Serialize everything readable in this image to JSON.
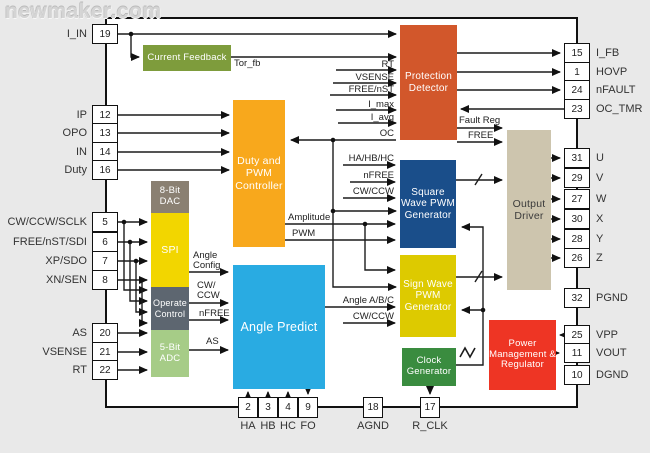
{
  "watermark": "newmaker.com",
  "colors": {
    "background": "#e9e9e9",
    "chip_fill": "#ffffff",
    "outline": "#111111",
    "current_feedback": "#7e9c3c",
    "duty_pwm": "#f8a81c",
    "dac": "#8a8072",
    "spi": "#f2d600",
    "operate_control": "#5d6670",
    "adc": "#a6cc87",
    "angle_predict": "#29abe2",
    "protection": "#d2572b",
    "square_pwm": "#1a4e8a",
    "sign_pwm": "#ddca00",
    "clock_gen": "#3a8c3f",
    "output_driver": "#cdc5ae",
    "power_mgmt": "#ee3524"
  },
  "blocks": {
    "current_feedback": "Current Feedback",
    "duty_pwm": "Duty and PWM Controller",
    "dac_8bit": "8-Bit DAC",
    "spi": "SPI",
    "operate_control": "Operate Control",
    "adc_5bit": "5-Bit ADC",
    "angle_predict": "Angle Predict",
    "protection_detector": "Protection Detector",
    "square_pwm": "Square Wave PWM Generator",
    "sign_pwm": "Sign Wave PWM Generator",
    "clock_gen": "Clock Generator",
    "output_driver": "Output Driver",
    "power_mgmt": "Power Management & Regulator"
  },
  "pins": {
    "left": [
      {
        "num": "19",
        "name": "I_IN"
      },
      {
        "num": "12",
        "name": "IP"
      },
      {
        "num": "13",
        "name": "OPO"
      },
      {
        "num": "14",
        "name": "IN"
      },
      {
        "num": "16",
        "name": "Duty"
      },
      {
        "num": "5",
        "name": "CW/CCW/SCLK"
      },
      {
        "num": "6",
        "name": "FREE/nST/SDI"
      },
      {
        "num": "7",
        "name": "XP/SDO"
      },
      {
        "num": "8",
        "name": "XN/SEN"
      },
      {
        "num": "20",
        "name": "AS"
      },
      {
        "num": "21",
        "name": "VSENSE"
      },
      {
        "num": "22",
        "name": "RT"
      }
    ],
    "right": [
      {
        "num": "15",
        "name": "I_FB"
      },
      {
        "num": "1",
        "name": "HOVP"
      },
      {
        "num": "24",
        "name": "nFAULT"
      },
      {
        "num": "23",
        "name": "OC_TMR"
      },
      {
        "num": "31",
        "name": "U"
      },
      {
        "num": "29",
        "name": "V"
      },
      {
        "num": "27",
        "name": "W"
      },
      {
        "num": "30",
        "name": "X"
      },
      {
        "num": "28",
        "name": "Y"
      },
      {
        "num": "26",
        "name": "Z"
      },
      {
        "num": "32",
        "name": "PGND"
      },
      {
        "num": "25",
        "name": "VPP"
      },
      {
        "num": "11",
        "name": "VOUT"
      },
      {
        "num": "10",
        "name": "DGND"
      }
    ],
    "bottom": [
      {
        "num": "2",
        "name": "HA"
      },
      {
        "num": "3",
        "name": "HB"
      },
      {
        "num": "4",
        "name": "HC"
      },
      {
        "num": "9",
        "name": "FO"
      },
      {
        "num": "18",
        "name": "AGND"
      },
      {
        "num": "17",
        "name": "R_CLK"
      }
    ]
  },
  "signals": {
    "tor_fb": "Tor_fb",
    "rt": "RT",
    "vsense": "VSENSE",
    "free_nst": "FREE/nST",
    "i_max": "I_max",
    "i_avg": "I_avg",
    "oc": "OC",
    "fault_reg": "Fault Reg",
    "free": "FREE",
    "ha_hb_hc": "HA/HB/HC",
    "nfree_sq": "nFREE",
    "cw_ccw_sq": "CW/CCW",
    "amplitude": "Amplitude",
    "pwm": "PWM",
    "angle_config": "Angle Config",
    "cw_ccw_ap": "CW/ CCW",
    "nfree_ap": "nFREE",
    "as_ap": "AS",
    "angle_abc": "Angle A/B/C",
    "cw_ccw_sign": "CW/CCW"
  }
}
